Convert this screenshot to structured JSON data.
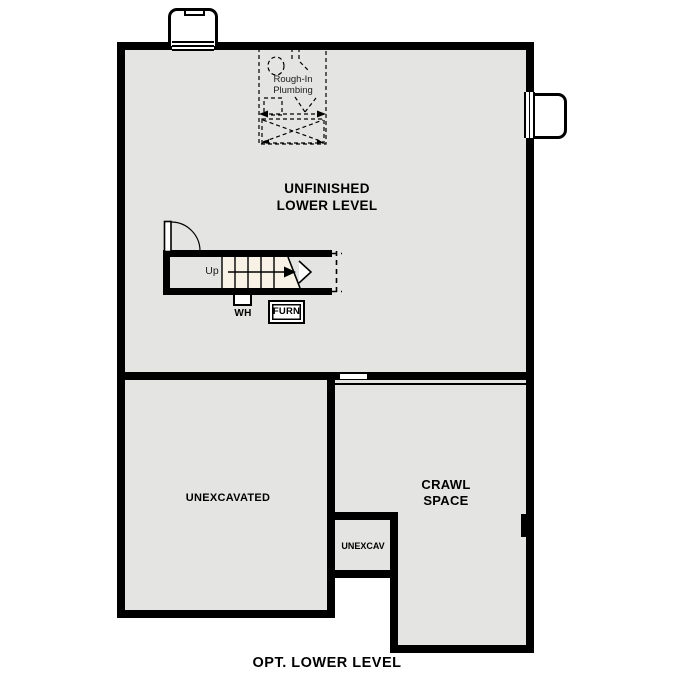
{
  "plan": {
    "caption": "OPT. LOWER LEVEL",
    "rooms": {
      "unfinished": {
        "label": "UNFINISHED\nLOWER LEVEL"
      },
      "unexcavated": {
        "label": "UNEXCAVATED"
      },
      "crawl": {
        "label": "CRAWL\nSPACE"
      },
      "unexcav": {
        "label": "UNEXCAV"
      }
    },
    "fixtures": {
      "plumbing": {
        "label": "Rough-In\nPlumbing"
      },
      "stairs": {
        "direction_label": "Up"
      },
      "water_heater": {
        "label": "WH"
      },
      "furnace": {
        "label": "FURN"
      }
    },
    "colors": {
      "wall": "#000000",
      "floor_fill": "#e4e4e2",
      "stair_fill": "#f8f2e6",
      "background": "#ffffff"
    }
  }
}
